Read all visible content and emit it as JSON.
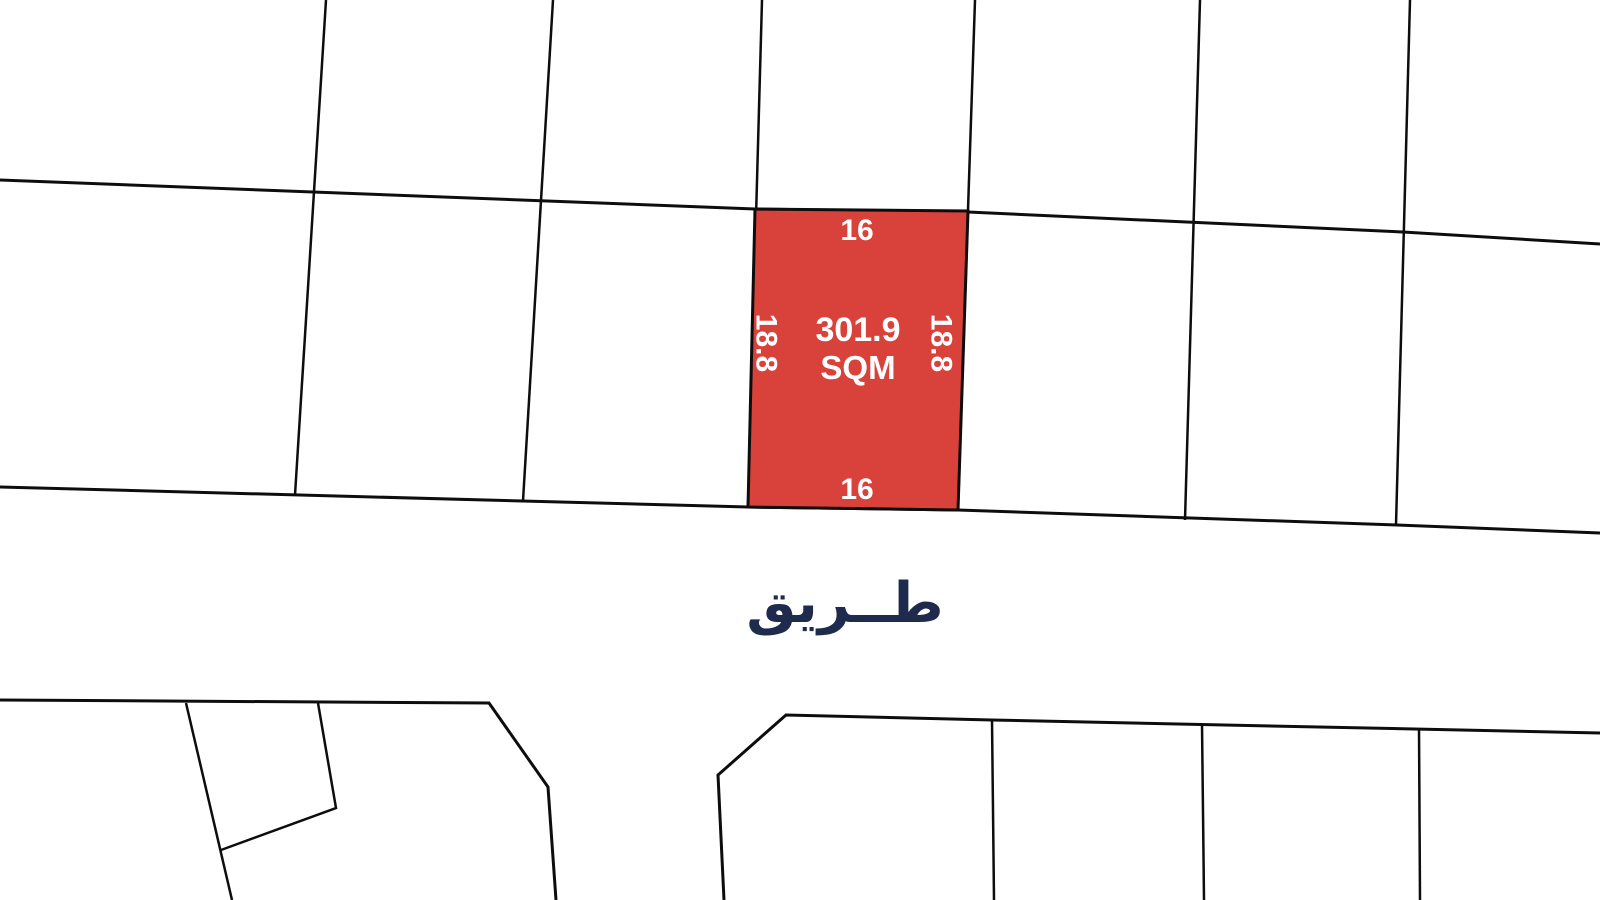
{
  "map": {
    "background_color": "#ffffff",
    "line_color": "#0d0d0d",
    "highlighted_plot": {
      "area_value": "301.9",
      "area_unit": "SQM",
      "dimensions": {
        "top": "16",
        "bottom": "16",
        "left": "18.8",
        "right": "18.8"
      },
      "fill_color": "#d9423a",
      "label_color": "#ffffff"
    },
    "road_label": {
      "text": "طــريق",
      "color": "#1e2b4d"
    }
  }
}
